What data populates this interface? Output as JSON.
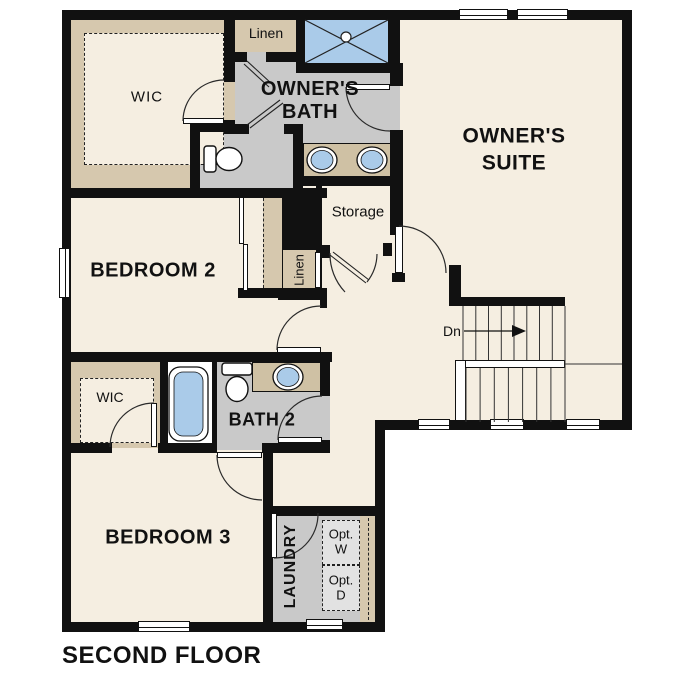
{
  "title": "SECOND FLOOR",
  "labels": {
    "wic_top": "WIC",
    "linen_top": "Linen",
    "owners_bath": "OWNER'S\nBATH",
    "owners_suite": "OWNER'S\nSUITE",
    "storage": "Storage",
    "linen_hall": "Linen",
    "bedroom2": "BEDROOM 2",
    "dn": "Dn",
    "wic_small": "WIC",
    "bath2": "BATH 2",
    "bedroom3": "BEDROOM 3",
    "laundry": "LAUNDRY",
    "opt_w": "Opt.\nW",
    "opt_d": "Opt.\nD"
  },
  "colors": {
    "wall": "#111111",
    "floor": "#f5eee1",
    "closet_tan": "#d6c8ae",
    "counter_tan": "#cfc1a4",
    "bath_gray": "#c9c9c9",
    "fixture_blue": "#aacbe9",
    "appliance_gray": "#e2e2e2",
    "line": "#2a2a2a"
  },
  "fixtures": [
    "shower",
    "double-vanity-sinks",
    "toilet",
    "bathtub",
    "toilet-2",
    "vanity-sink-2",
    "stairs-down",
    "optional-washer",
    "optional-dryer"
  ]
}
